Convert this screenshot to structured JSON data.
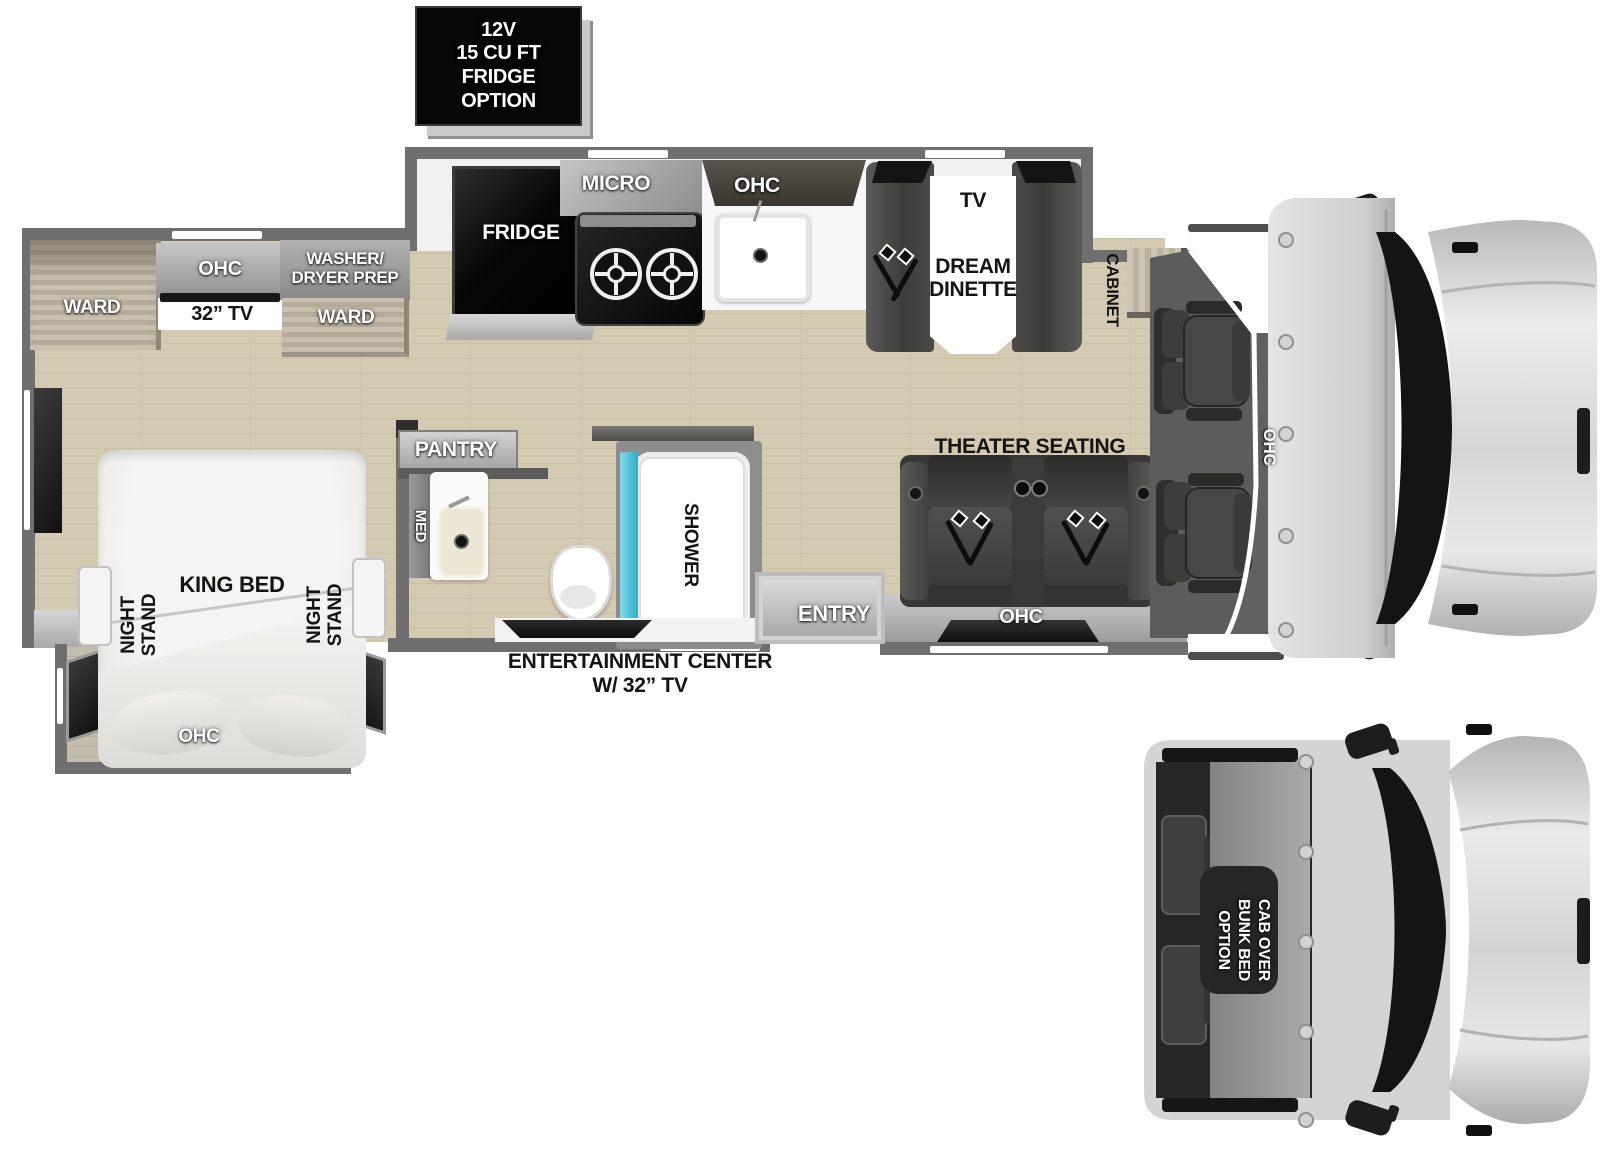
{
  "option_box": {
    "text": "12V\n15 CU FT\nFRIDGE\nOPTION"
  },
  "kitchen": {
    "fridge": "FRIDGE",
    "micro": "MICRO",
    "ohc": "OHC"
  },
  "dinette": {
    "tv": "TV",
    "name": "DREAM\nDINETTE"
  },
  "cab": {
    "cabinet": "CABINET",
    "ohc": "OHC"
  },
  "bedroom": {
    "ohc": "OHC",
    "tv": "32” TV",
    "washer_dryer": "WASHER/\nDRYER PREP",
    "ward_left": "WARD",
    "ward_right": "WARD",
    "king_bed": "KING BED",
    "night_stand_left": "NIGHT\nSTAND",
    "night_stand_right": "NIGHT\nSTAND",
    "slide_ohc": "OHC"
  },
  "bathroom": {
    "pantry": "PANTRY",
    "med": "MED",
    "shower": "SHOWER"
  },
  "living": {
    "entry": "ENTRY",
    "theater": "THEATER SEATING",
    "ohc": "OHC",
    "entertainment": "ENTERTAINMENT CENTER\nW/ 32” TV"
  },
  "bunk_option": {
    "text": "CAB OVER\nBUNK BED\nOPTION"
  },
  "colors": {
    "floor": "#d4c9b1",
    "wall": "#6f6f6f",
    "shower_glass": "#3bbfd6",
    "appliance": "#0c0c0c",
    "furniture": "#45443f"
  }
}
